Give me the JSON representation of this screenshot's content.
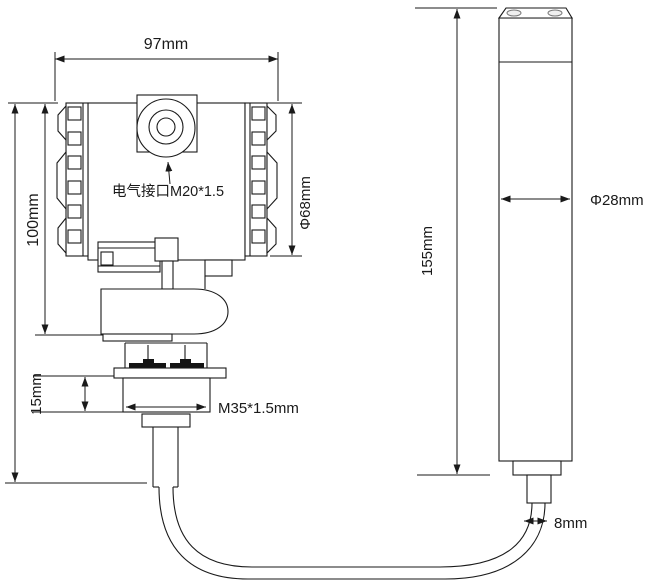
{
  "drawing": {
    "title": "pressure-transmitter-dimension-drawing",
    "colors": {
      "background": "#ffffff",
      "line": "#1a1a1a"
    },
    "transmitter": {
      "labels": {
        "width": "97mm",
        "height": "100mm",
        "housing_diameter": "Φ68mm",
        "electrical_port": "电气接口M20*1.5",
        "thread_height": "15mm",
        "thread_spec": "M35*1.5mm"
      }
    },
    "probe": {
      "labels": {
        "length": "155mm",
        "diameter": "Φ28mm",
        "cable_diameter": "8mm"
      }
    }
  }
}
